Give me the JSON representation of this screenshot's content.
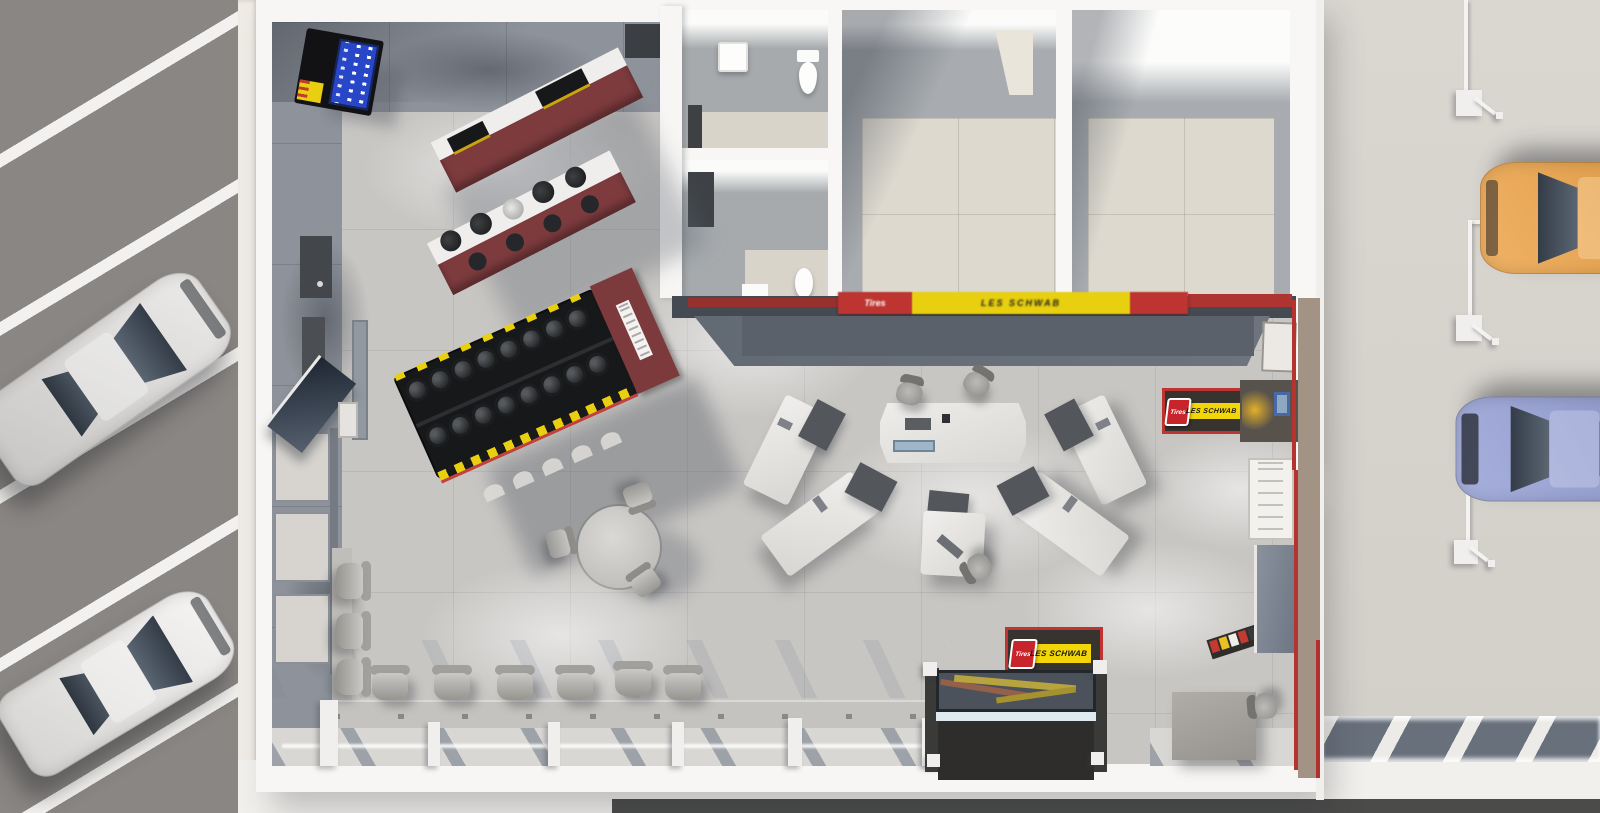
{
  "scene": {
    "description": "Overhead 3D rendering of a Les Schwab tire store: showroom with tire displays and sales desks, back rooms with restrooms, customer parking lot at left, service bay area with vehicles at right",
    "view": "top-down"
  },
  "brand": {
    "name": "LES SCHWAB",
    "badge": "Tires",
    "colors": {
      "yellow": "#f2d60a",
      "red": "#c8242b",
      "dark": "#37332f"
    }
  },
  "signs": {
    "wall_banner": {
      "label": "LES SCHWAB",
      "badge": "Tires"
    },
    "floor_mat": {
      "label": "LES SCHWAB",
      "badge": "Tires"
    },
    "entrance": {
      "label": "LES SCHWAB",
      "badge": "Tires"
    }
  },
  "areas": {
    "parking_lot": {
      "surface": "asphalt with white diagonal stripes",
      "vehicles": [
        "silver sedan",
        "white sedan"
      ]
    },
    "showroom": {
      "furniture": [
        "beverage vending machine",
        "retail display shelf",
        "wheel display shelf",
        "tire display rack",
        "wall tv kiosk",
        "round cafe table with 3 chairs",
        "row of 6 waiting chairs",
        "column of 3 waiting chairs",
        "central sales counter",
        "angled sales desks",
        "side sales desk",
        "les schwab floor mat",
        "brochure rack",
        "entrance vestibule",
        "side kiosk cabinet"
      ]
    },
    "back_rooms": [
      "restroom 1",
      "restroom 2",
      "back room",
      "storage room"
    ],
    "service_area": {
      "vehicles": [
        "orange suv",
        "blue sedan"
      ],
      "equipment": "overhead air line drops",
      "glazing": "storefront with diagonal mullions"
    }
  }
}
